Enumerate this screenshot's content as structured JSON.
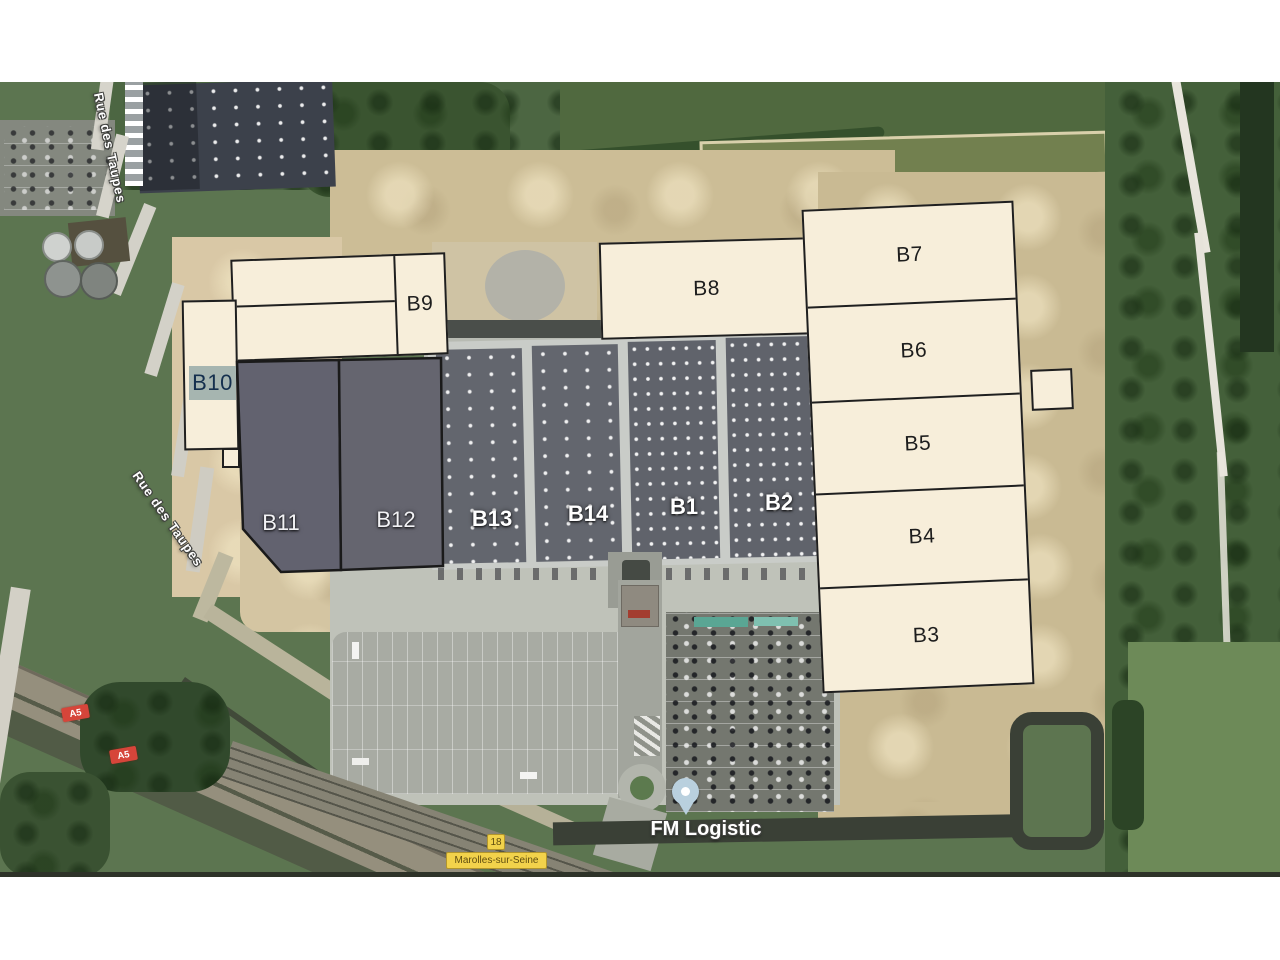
{
  "map": {
    "pin_label": "FM Logistic",
    "street_label_top": "Rue des Taupes",
    "street_label_mid": "Rue des Taupes",
    "motorway_badges": [
      "A5",
      "A5"
    ],
    "route_badge": "18",
    "town_label": "Marolles-sur-Seine",
    "buildings": {
      "b1": "B1",
      "b2": "B2",
      "b3": "B3",
      "b4": "B4",
      "b5": "B5",
      "b6": "B6",
      "b7": "B7",
      "b8": "B8",
      "b9": "B9",
      "b10": "B10",
      "b11": "B11",
      "b12": "B12",
      "b13": "B13",
      "b14": "B14"
    },
    "colors": {
      "parcel_fill": "#f7eeda",
      "parcel_border": "#1f1f1f",
      "reserved_parcel_fill": "#62626f",
      "b10_chip": "#a6b5b0",
      "pin_fill": "#b9d0de",
      "motorway_badge_red": "#d6453a",
      "route_badge_yellow": "#f2d24b"
    }
  }
}
